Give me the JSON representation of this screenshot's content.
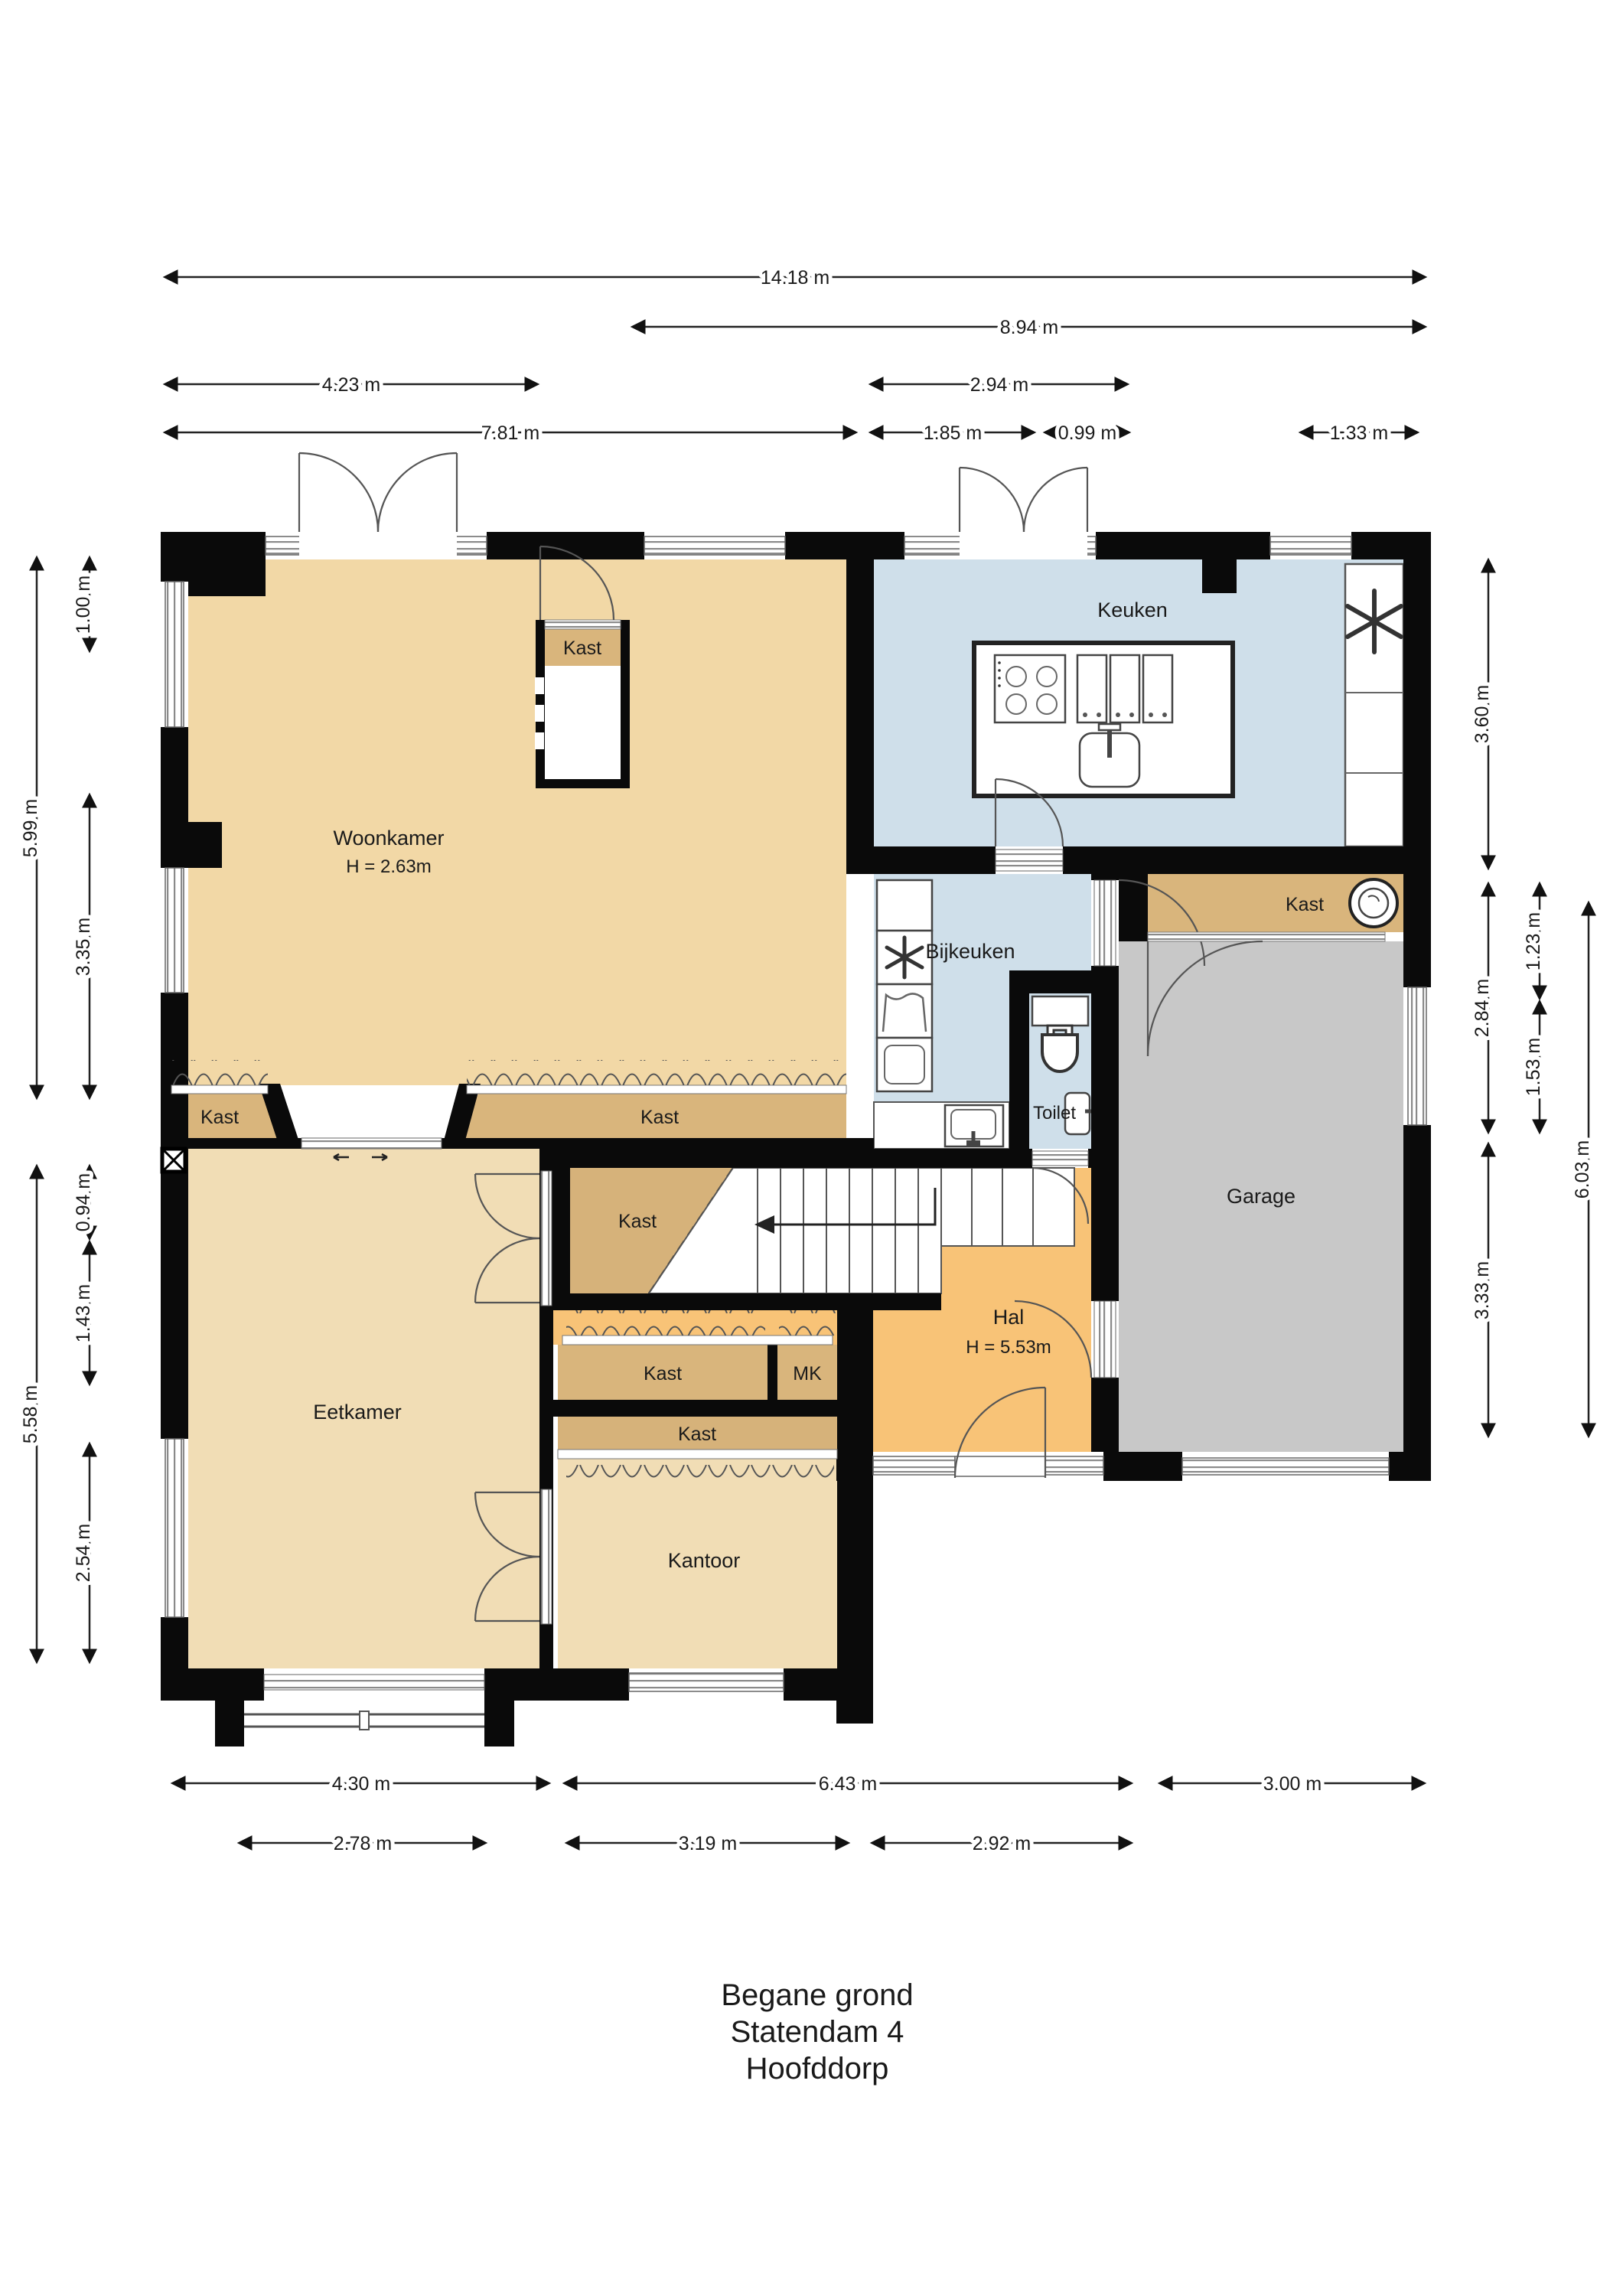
{
  "title": {
    "line1": "Begane grond",
    "line2": "Statendam 4",
    "line3": "Hoofddorp"
  },
  "rooms": {
    "woonkamer": {
      "label": "Woonkamer",
      "height": "H = 2.63m"
    },
    "keuken": {
      "label": "Keuken"
    },
    "bijkeuken": {
      "label": "Bijkeuken"
    },
    "toilet": {
      "label": "Toilet"
    },
    "garage": {
      "label": "Garage"
    },
    "hal": {
      "label": "Hal",
      "height": "H = 5.53m"
    },
    "eetkamer": {
      "label": "Eetkamer"
    },
    "kantoor": {
      "label": "Kantoor"
    }
  },
  "closets": {
    "woonkamer_center": "Kast",
    "woonkamer_left": "Kast",
    "woonkamer_wall": "Kast",
    "under_stairs": "Kast",
    "hal_row": "Kast",
    "meter_cupboard": "MK",
    "kantoor_row": "Kast",
    "garage": "Kast"
  },
  "dimensions": {
    "top": [
      "14.18 m",
      "8.94 m",
      "4.23 m",
      "2.94 m",
      "7.81 m",
      "1.85 m",
      "0.99 m",
      "1.33 m"
    ],
    "left": [
      "5.99 m",
      "1.00 m",
      "3.35 m",
      "5.58 m",
      "0.94 m",
      "1.43 m",
      "2.54 m"
    ],
    "right": [
      "3.60 m",
      "2.84 m",
      "3.33 m",
      "1.23 m",
      "1.53 m",
      "6.03 m"
    ],
    "bottom": [
      "4.30 m",
      "6.43 m",
      "3.00 m",
      "2.78 m",
      "3.19 m",
      "2.92 m"
    ]
  },
  "icons": {
    "washing_machine": "washing-machine-icon",
    "freezer": "snowflake-icon",
    "extractor": "fan-icon",
    "laundry_basket": "basket-icon",
    "cooktop": "cooktop-icon",
    "sink": "sink-icon",
    "toilet_bowl": "toilet-icon",
    "stairs": "stairs-up-arrow-icon"
  },
  "colors": {
    "living": "#f2d8a6",
    "dining": "#f1ddb5",
    "kitchen": "#cfdfea",
    "hall": "#f8c377",
    "garage": "#c8c8c8",
    "closet": "#d9b57c",
    "closet_dark": "#d6b27a",
    "wall": "#0a0a0a"
  }
}
